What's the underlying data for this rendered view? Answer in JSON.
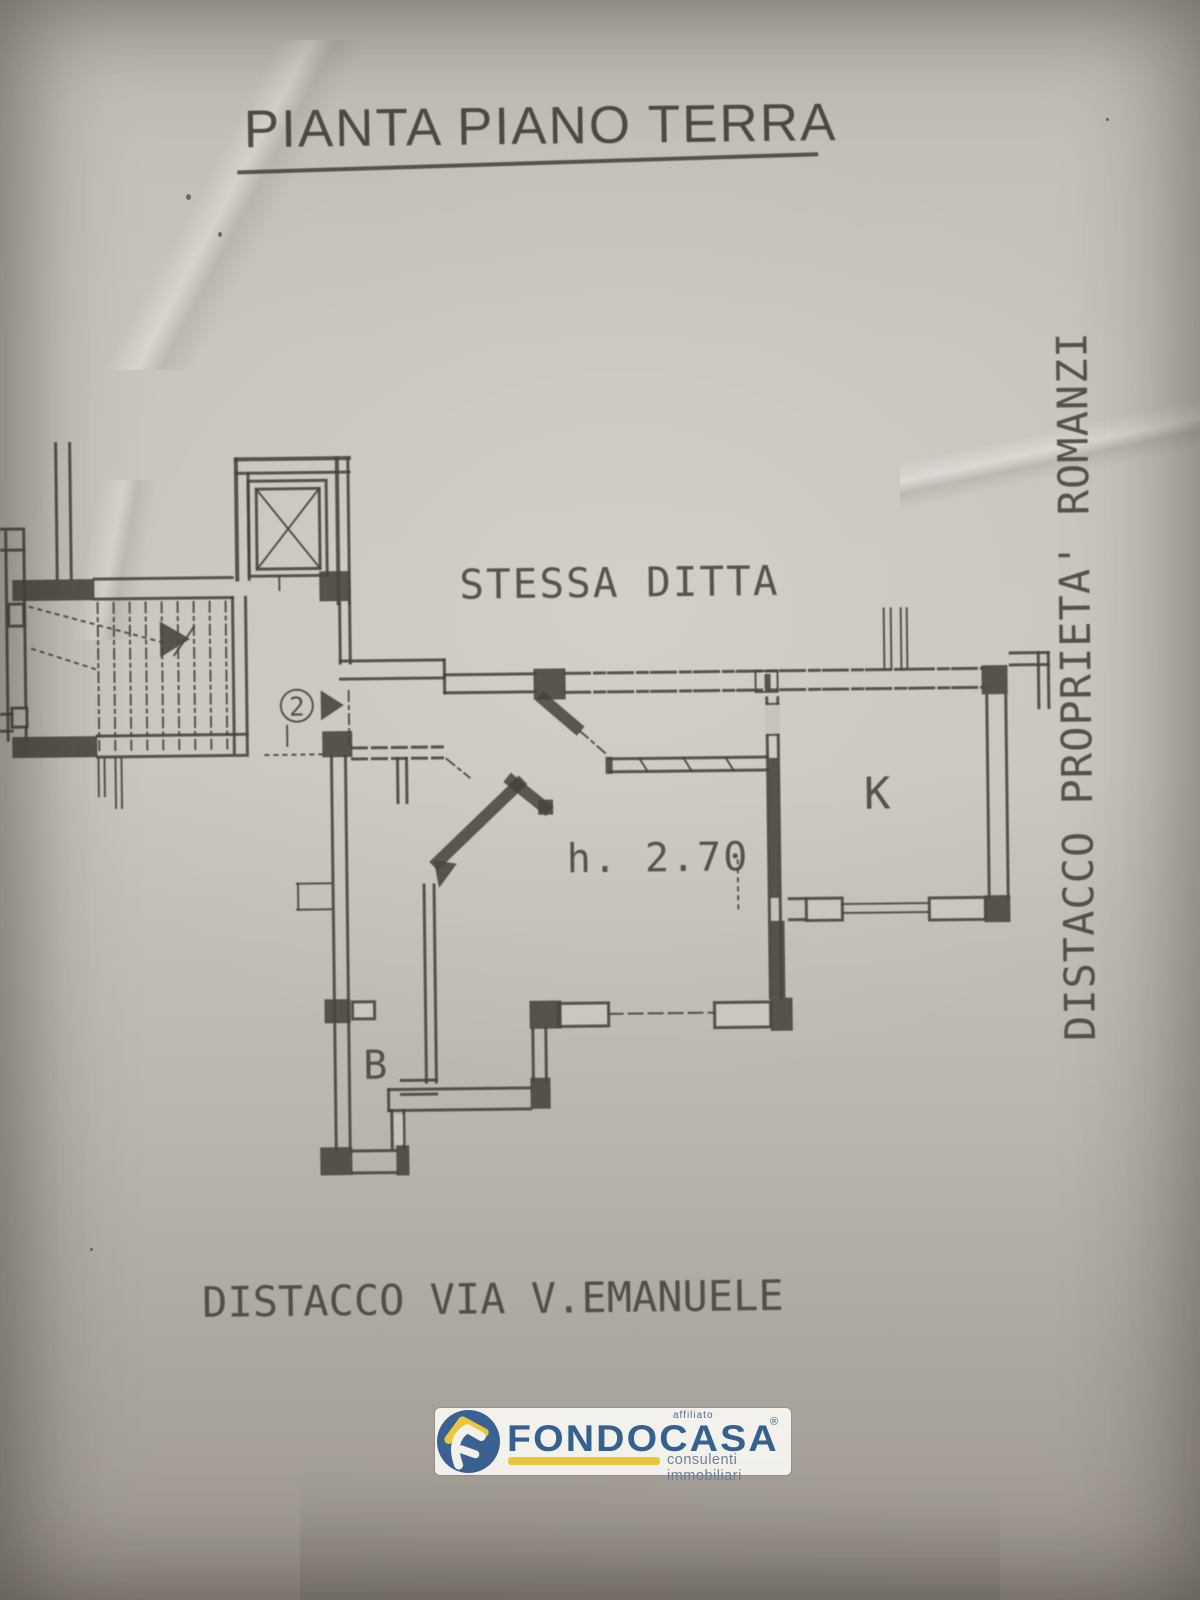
{
  "title": "PIANTA PIANO TERRA",
  "plan": {
    "labels": {
      "adjacent_property_top": "STESSA DITTA",
      "ceiling_height": "h. 2.70",
      "kitchen": "K",
      "bath": "B",
      "unit_number": "2",
      "boundary_right_vertical": "DISTACCO PROPRIETA' ROMANZI",
      "boundary_bottom": "DISTACCO VIA V.EMANUELE"
    },
    "ink_color": "#45423c",
    "paper_color": "#c4bfb7"
  },
  "logo": {
    "affiliate_note": "affiliato",
    "brand": "FONDOCASA",
    "registered_mark": "®",
    "tagline": "consulenti immobiliari",
    "brand_color": "#35608f",
    "accent_color": "#e9c73c"
  }
}
